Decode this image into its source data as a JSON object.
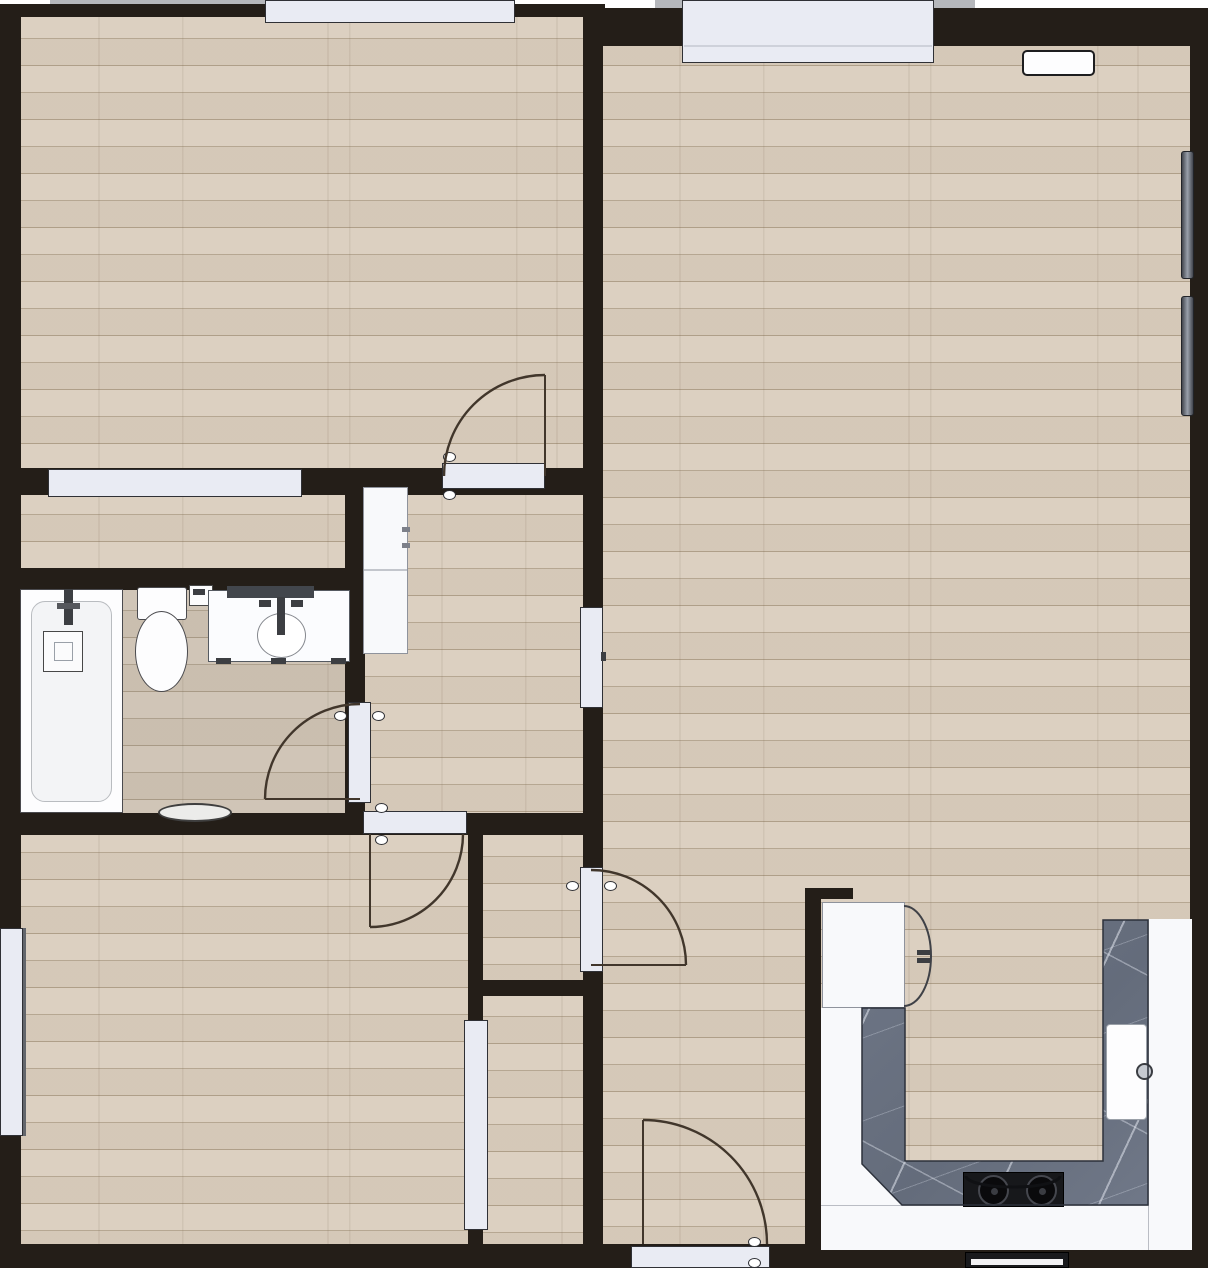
{
  "canvas": {
    "w": 1208,
    "h": 1268
  },
  "palette": {
    "wall": "#241e18",
    "floor": "#dacebe",
    "floor_line": "#b2a28c",
    "slab": "#e9ebf3",
    "slab_border": "#2f3035",
    "arc": "#41362b",
    "marble": "#6b7383",
    "cabinet": "#f8f9fb",
    "stove": "#17181b",
    "exterior_strip": "#b5b7bb"
  },
  "elements": [
    {
      "n": "exterior-strip-top-left",
      "cls": "ext",
      "i": false,
      "b": [
        50,
        0,
        465,
        7
      ]
    },
    {
      "n": "exterior-strip-top-right",
      "cls": "ext",
      "i": false,
      "b": [
        655,
        0,
        320,
        10
      ]
    },
    {
      "n": "floor-bedroom-1",
      "cls": "wood",
      "i": false,
      "b": [
        15,
        12,
        575,
        462
      ]
    },
    {
      "n": "floor-bedroom1-closet-strip",
      "cls": "wood",
      "i": false,
      "b": [
        15,
        488,
        345,
        88
      ]
    },
    {
      "n": "floor-bathroom",
      "cls": "wood",
      "i": false,
      "b": [
        15,
        584,
        345,
        236
      ]
    },
    {
      "n": "floor-bathroom-tint",
      "cls": "tint",
      "i": false,
      "b": [
        15,
        584,
        345,
        236
      ]
    },
    {
      "n": "floor-hallway",
      "cls": "wood",
      "i": false,
      "b": [
        358,
        488,
        232,
        332
      ]
    },
    {
      "n": "floor-bedroom-2",
      "cls": "wood",
      "i": false,
      "b": [
        15,
        826,
        460,
        424
      ]
    },
    {
      "n": "floor-living-room-closet",
      "cls": "wood",
      "i": false,
      "b": [
        478,
        830,
        112,
        156
      ]
    },
    {
      "n": "floor-bedroom2-closet",
      "cls": "wood",
      "i": false,
      "b": [
        478,
        990,
        112,
        260
      ]
    },
    {
      "n": "floor-living-room",
      "cls": "wood",
      "i": false,
      "b": [
        596,
        12,
        600,
        1238
      ]
    },
    {
      "n": "wall-top-left",
      "cls": "wall",
      "i": false,
      "b": [
        0,
        4,
        605,
        13
      ]
    },
    {
      "n": "wall-top-right",
      "cls": "wall",
      "i": false,
      "b": [
        583,
        8,
        625,
        38
      ]
    },
    {
      "n": "wall-left",
      "cls": "wall",
      "i": false,
      "b": [
        0,
        4,
        21,
        1264
      ]
    },
    {
      "n": "wall-bottom",
      "cls": "wall",
      "i": false,
      "b": [
        0,
        1244,
        1208,
        24
      ]
    },
    {
      "n": "wall-right",
      "cls": "wall",
      "i": false,
      "b": [
        1190,
        8,
        18,
        1260
      ]
    },
    {
      "n": "wall-center-vertical",
      "cls": "wall",
      "i": false,
      "b": [
        583,
        4,
        20,
        1240
      ]
    },
    {
      "n": "wall-bedroom1-bottom",
      "cls": "wall",
      "i": false,
      "b": [
        0,
        468,
        603,
        27
      ]
    },
    {
      "n": "wall-bathroom-top",
      "cls": "wall",
      "i": false,
      "b": [
        20,
        568,
        345,
        22
      ]
    },
    {
      "n": "wall-bathroom-right",
      "cls": "wall",
      "i": false,
      "b": [
        345,
        468,
        20,
        347
      ]
    },
    {
      "n": "wall-bathroom-bottom",
      "cls": "wall",
      "i": false,
      "b": [
        0,
        813,
        603,
        22
      ]
    },
    {
      "n": "wall-bedroom2-right",
      "cls": "wall",
      "i": false,
      "b": [
        468,
        828,
        15,
        416
      ]
    },
    {
      "n": "wall-closet-bottom",
      "cls": "wall",
      "i": false,
      "b": [
        483,
        980,
        120,
        16
      ]
    },
    {
      "n": "wall-kitchen-left",
      "cls": "wall",
      "i": false,
      "b": [
        805,
        888,
        16,
        356
      ]
    },
    {
      "n": "wall-kitchen-top-stub",
      "cls": "wall",
      "i": false,
      "b": [
        805,
        888,
        48,
        11
      ]
    },
    {
      "n": "window-bedroom1-top",
      "cls": "slab",
      "i": true,
      "b": [
        265,
        0,
        250,
        23
      ]
    },
    {
      "n": "window-living-room-top",
      "cls": "slab",
      "i": true,
      "b": [
        682,
        0,
        252,
        63
      ]
    },
    {
      "n": "window-living-room-sill-line",
      "cls": "plain",
      "i": false,
      "b": [
        684,
        45,
        248,
        2
      ],
      "s": "background:#ced1da;"
    },
    {
      "n": "opening-bedroom1-closet",
      "cls": "slab",
      "i": true,
      "b": [
        48,
        469,
        254,
        28
      ]
    },
    {
      "n": "window-bedroom2-left",
      "cls": "slab",
      "i": true,
      "b": [
        0,
        928,
        23,
        208
      ]
    },
    {
      "n": "window-bedroom2-frame-line",
      "cls": "plain",
      "i": false,
      "b": [
        23,
        928,
        3,
        208
      ],
      "s": "background:#63666c;"
    },
    {
      "n": "door-bedroom-1",
      "cls": "slab",
      "i": true,
      "b": [
        442,
        463,
        103,
        26
      ]
    },
    {
      "n": "door-hallway-living",
      "cls": "slab",
      "i": true,
      "b": [
        580,
        607,
        23,
        101
      ]
    },
    {
      "n": "door-hallway-living-handle",
      "cls": "dark",
      "i": false,
      "b": [
        601,
        652,
        5,
        9
      ]
    },
    {
      "n": "door-bathroom",
      "cls": "slab",
      "i": true,
      "b": [
        348,
        702,
        23,
        101
      ]
    },
    {
      "n": "door-bedroom-2",
      "cls": "slab",
      "i": true,
      "b": [
        363,
        811,
        104,
        23
      ]
    },
    {
      "n": "door-living-closet",
      "cls": "slab",
      "i": true,
      "b": [
        580,
        867,
        23,
        105
      ]
    },
    {
      "n": "opening-bedroom2-closet",
      "cls": "slab",
      "i": true,
      "b": [
        464,
        1020,
        24,
        210
      ]
    },
    {
      "n": "door-entry",
      "cls": "slab",
      "i": true,
      "b": [
        631,
        1246,
        139,
        22
      ]
    },
    {
      "n": "knob-bedroom1-door-a",
      "cls": "knob",
      "i": false,
      "b": [
        443,
        452,
        13,
        10
      ]
    },
    {
      "n": "knob-bedroom1-door-b",
      "cls": "knob",
      "i": false,
      "b": [
        443,
        490,
        13,
        10
      ]
    },
    {
      "n": "knob-bathroom-door-a",
      "cls": "knob",
      "i": false,
      "b": [
        334,
        711,
        13,
        10
      ]
    },
    {
      "n": "knob-bathroom-door-b",
      "cls": "knob",
      "i": false,
      "b": [
        372,
        711,
        13,
        10
      ]
    },
    {
      "n": "knob-bedroom2-door-a",
      "cls": "knob",
      "i": false,
      "b": [
        375,
        803,
        13,
        10
      ]
    },
    {
      "n": "knob-bedroom2-door-b",
      "cls": "knob",
      "i": false,
      "b": [
        375,
        835,
        13,
        10
      ]
    },
    {
      "n": "knob-closet-door-a",
      "cls": "knob",
      "i": false,
      "b": [
        566,
        881,
        13,
        10
      ]
    },
    {
      "n": "knob-closet-door-b",
      "cls": "knob",
      "i": false,
      "b": [
        604,
        881,
        13,
        10
      ]
    },
    {
      "n": "knob-entry-door-a",
      "cls": "knob",
      "i": false,
      "b": [
        748,
        1237,
        13,
        10
      ]
    },
    {
      "n": "knob-entry-door-b",
      "cls": "knob",
      "i": false,
      "b": [
        748,
        1258,
        13,
        10
      ]
    },
    {
      "n": "radiator-living-upper",
      "cls": "radiator",
      "i": true,
      "b": [
        1181,
        151,
        13,
        128
      ]
    },
    {
      "n": "radiator-living-lower",
      "cls": "radiator",
      "i": true,
      "b": [
        1181,
        296,
        13,
        120
      ]
    },
    {
      "n": "vent-living-top",
      "cls": "vent",
      "i": true,
      "b": [
        1022,
        50,
        73,
        26
      ]
    },
    {
      "n": "hall-wardrobe",
      "cls": "cab",
      "i": true,
      "b": [
        363,
        487,
        45,
        167
      ]
    },
    {
      "n": "hall-wardrobe-divider",
      "cls": "plain",
      "i": false,
      "b": [
        364,
        569,
        43,
        2
      ],
      "s": "background:#c3c6cc;"
    },
    {
      "n": "hall-wardrobe-handle-a",
      "cls": "plain",
      "i": false,
      "b": [
        402,
        527,
        8,
        5
      ],
      "s": "background:#7d8089;"
    },
    {
      "n": "hall-wardrobe-handle-b",
      "cls": "plain",
      "i": false,
      "b": [
        402,
        543,
        8,
        5
      ],
      "s": "background:#7d8089;"
    },
    {
      "n": "kitchen-cabinet-left-band",
      "cls": "plain",
      "i": true,
      "b": [
        821,
        1008,
        84,
        197
      ],
      "s": "background:#f8f9fb;"
    },
    {
      "n": "kitchen-cabinet-bottom-band",
      "cls": "plain",
      "i": true,
      "b": [
        821,
        1205,
        371,
        45
      ],
      "s": "background:#f8f9fb;border-top:1px solid #babdc4;"
    },
    {
      "n": "kitchen-cabinet-right-band",
      "cls": "plain",
      "i": true,
      "b": [
        1148,
        919,
        44,
        331
      ],
      "s": "background:#f8f9fb;border-left:1px solid #babdc4;"
    },
    {
      "n": "fridge",
      "cls": "cab",
      "i": true,
      "b": [
        822,
        902,
        83,
        106
      ]
    },
    {
      "n": "fridge-handle-a",
      "cls": "dark",
      "i": false,
      "b": [
        917,
        950,
        14,
        5
      ]
    },
    {
      "n": "fridge-handle-b",
      "cls": "dark",
      "i": false,
      "b": [
        917,
        958,
        14,
        5
      ]
    },
    {
      "n": "kitchen-countertop",
      "cls": "marble",
      "i": true,
      "b": [
        861,
        920,
        287,
        290
      ],
      "s": "clip-path:polygon(1px 88px,44px 88px,44px 241px,242px 241px,242px 0px,287px 0px,287px 285px,41px 285px,1px 244px);"
    },
    {
      "n": "kitchen-sink",
      "cls": "plain",
      "i": true,
      "b": [
        1106,
        1024,
        41,
        96
      ],
      "s": "background:#fdfdfe;border:1.5px solid #9aa0a8;border-radius:4px;"
    },
    {
      "n": "kitchen-sink-faucet",
      "cls": "plain",
      "i": false,
      "b": [
        1136,
        1063,
        17,
        17
      ],
      "s": "background:#c6cad1;border:2px solid #3a3d42;border-radius:50%;"
    },
    {
      "n": "stove",
      "cls": "stove",
      "i": true,
      "b": [
        963,
        1172,
        101,
        35
      ]
    },
    {
      "n": "stove-burner-left",
      "cls": "burner",
      "i": false,
      "b": [
        978,
        1175,
        31,
        31
      ]
    },
    {
      "n": "stove-burner-right",
      "cls": "burner",
      "i": false,
      "b": [
        1026,
        1175,
        31,
        31
      ]
    },
    {
      "n": "stove-burner-left-dot",
      "cls": "plain",
      "i": false,
      "b": [
        991,
        1188,
        7,
        7
      ],
      "s": "background:#3a3c42;border-radius:50%;"
    },
    {
      "n": "stove-burner-right-dot",
      "cls": "plain",
      "i": false,
      "b": [
        1039,
        1188,
        7,
        7
      ],
      "s": "background:#3a3c42;border-radius:50%;"
    },
    {
      "n": "oven-front",
      "cls": "plain",
      "i": true,
      "b": [
        965,
        1252,
        104,
        16
      ],
      "s": "background:#191a1d;border:1px solid #000;"
    },
    {
      "n": "oven-front-handle",
      "cls": "plain",
      "i": false,
      "b": [
        971,
        1259,
        92,
        6
      ],
      "s": "background:#f2f2f4;"
    },
    {
      "n": "bathtub",
      "cls": "fixture",
      "i": true,
      "b": [
        20,
        589,
        103,
        224
      ]
    },
    {
      "n": "bathtub-inner",
      "cls": "plain",
      "i": false,
      "b": [
        31,
        601,
        81,
        201
      ],
      "s": "background:#f3f4f6;border:1.5px solid #b9bcc0;border-radius:14px;"
    },
    {
      "n": "bathtub-faucet",
      "cls": "dark",
      "i": false,
      "b": [
        64,
        589,
        9,
        36
      ]
    },
    {
      "n": "bathtub-faucet-bar",
      "cls": "plain",
      "i": false,
      "b": [
        57,
        603,
        23,
        6
      ],
      "s": "background:#55575c;"
    },
    {
      "n": "shower-control-box",
      "cls": "plain",
      "i": false,
      "b": [
        43,
        631,
        40,
        41
      ],
      "s": "background:#fbfbfc;border:1.5px solid #474747;"
    },
    {
      "n": "shower-control-inner",
      "cls": "plain",
      "i": false,
      "b": [
        54,
        642,
        19,
        19
      ],
      "s": "border:1.2px solid #9aa0a8;"
    },
    {
      "n": "toilet-tank",
      "cls": "fixture",
      "i": true,
      "b": [
        137,
        587,
        50,
        33
      ],
      "s": "border-radius:3px;"
    },
    {
      "n": "toilet-bowl",
      "cls": "fixture",
      "i": true,
      "b": [
        135,
        611,
        53,
        81
      ],
      "s": "border-radius:50%;"
    },
    {
      "n": "toilet-paper-holder",
      "cls": "plain",
      "i": false,
      "b": [
        189,
        585,
        24,
        21
      ],
      "s": "background:#fcfcfd;border:1.5px solid #474747;"
    },
    {
      "n": "toilet-paper-roll",
      "cls": "dark",
      "i": false,
      "b": [
        193,
        589,
        12,
        6
      ]
    },
    {
      "n": "vanity",
      "cls": "plain",
      "i": true,
      "b": [
        208,
        590,
        142,
        72
      ],
      "s": "background:#fbfcfe;border:1.5px solid #555a61;"
    },
    {
      "n": "vanity-backsplash",
      "cls": "plain",
      "i": false,
      "b": [
        227,
        586,
        87,
        12
      ],
      "s": "background:#42464c;"
    },
    {
      "n": "vanity-basin",
      "cls": "plain",
      "i": false,
      "b": [
        257,
        613,
        49,
        45
      ],
      "s": "background:#ffffff;border:1.5px solid #85888e;border-radius:50%;"
    },
    {
      "n": "vanity-faucet",
      "cls": "dark",
      "i": false,
      "b": [
        277,
        597,
        8,
        38
      ]
    },
    {
      "n": "vanity-handle-left",
      "cls": "dark",
      "i": false,
      "b": [
        259,
        600,
        12,
        7
      ]
    },
    {
      "n": "vanity-handle-right",
      "cls": "dark",
      "i": false,
      "b": [
        291,
        600,
        12,
        7
      ]
    },
    {
      "n": "vanity-foot-a",
      "cls": "dark",
      "i": false,
      "b": [
        216,
        658,
        15,
        6
      ]
    },
    {
      "n": "vanity-foot-b",
      "cls": "dark",
      "i": false,
      "b": [
        271,
        658,
        15,
        6
      ]
    },
    {
      "n": "vanity-foot-c",
      "cls": "dark",
      "i": false,
      "b": [
        331,
        658,
        15,
        6
      ]
    },
    {
      "n": "bath-mat",
      "cls": "plain",
      "i": true,
      "b": [
        158,
        803,
        74,
        19
      ],
      "s": "background:#ececea;border:2px solid #3f3f3f;border-radius:50%;"
    }
  ],
  "strokes": [
    {
      "n": "door-arc-bedroom-1",
      "d": "M444,476 A101,101 0 0 1 545,375"
    },
    {
      "n": "door-open-line-bedroom-1",
      "d": "M545,375 L545,476",
      "w": 2
    },
    {
      "n": "door-arc-bathroom",
      "d": "M360,704 A95,95 0 0 0 265,799"
    },
    {
      "n": "door-open-line-bathroom",
      "d": "M265,799 L360,799",
      "w": 2
    },
    {
      "n": "door-arc-bedroom-2",
      "d": "M463,834 A93,93 0 0 1 370,927"
    },
    {
      "n": "door-open-line-bedroom-2",
      "d": "M370,834 L370,927",
      "w": 2
    },
    {
      "n": "door-arc-living-closet",
      "d": "M591,870 A95,95 0 0 1 686,965"
    },
    {
      "n": "door-open-line-living-closet",
      "d": "M591,965 L686,965",
      "w": 2
    },
    {
      "n": "door-arc-entry",
      "d": "M767,1244 A124,124 0 0 0 643,1120"
    },
    {
      "n": "door-open-line-entry",
      "d": "M643,1120 L643,1244",
      "w": 2
    },
    {
      "n": "fridge-door-arc",
      "d": "M904,906 A27,50 0 0 1 904,1006",
      "c": "#3f4147",
      "w": 2
    },
    {
      "n": "stove-handle-arc",
      "d": "M966,1176 A47,11 0 0 0 1060,1176",
      "c": "#101114",
      "w": 3
    },
    {
      "n": "countertop-outline",
      "d": "M862,1008 L905,1008 L905,1161 L1103,1161 L1103,920 L1148,920 L1148,1205 L902,1205 L862,1164 Z",
      "c": "#2c313b",
      "w": 1.5
    }
  ]
}
